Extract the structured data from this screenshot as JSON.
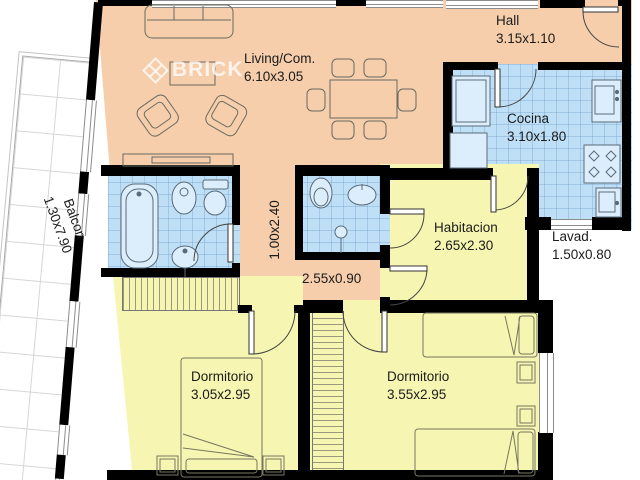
{
  "plan": {
    "watermark": "BRICK",
    "rooms": {
      "living": {
        "label": "Living/Com.",
        "dims": "6.10x3.05"
      },
      "hall": {
        "label": "Hall",
        "dims": "3.15x1.10"
      },
      "cocina": {
        "label": "Cocina",
        "dims": "3.10x1.80"
      },
      "habitacion": {
        "label": "Habitacion",
        "dims": "2.65x2.30"
      },
      "lavadero": {
        "label": "Lavad.",
        "dims": "1.50x0.80"
      },
      "dormitorio1": {
        "label": "Dormitorio",
        "dims": "3.05x2.95"
      },
      "dormitorio2": {
        "label": "Dormitorio",
        "dims": "3.55x2.95"
      },
      "balcon": {
        "label": "Balcon",
        "dims": "1.30x7.90"
      },
      "pasillo": {
        "dims": "1.00x2.40"
      },
      "distribuidor": {
        "dims": "2.55x0.90"
      }
    },
    "colors": {
      "living_floor": "#F6CEAB",
      "bedroom_floor": "#F6F6B2",
      "wet_floor": "#BFDFF6",
      "wall": "#000000",
      "fixture_fill": "#DCEDFB",
      "fixture_outline": "#5a6b78"
    }
  }
}
